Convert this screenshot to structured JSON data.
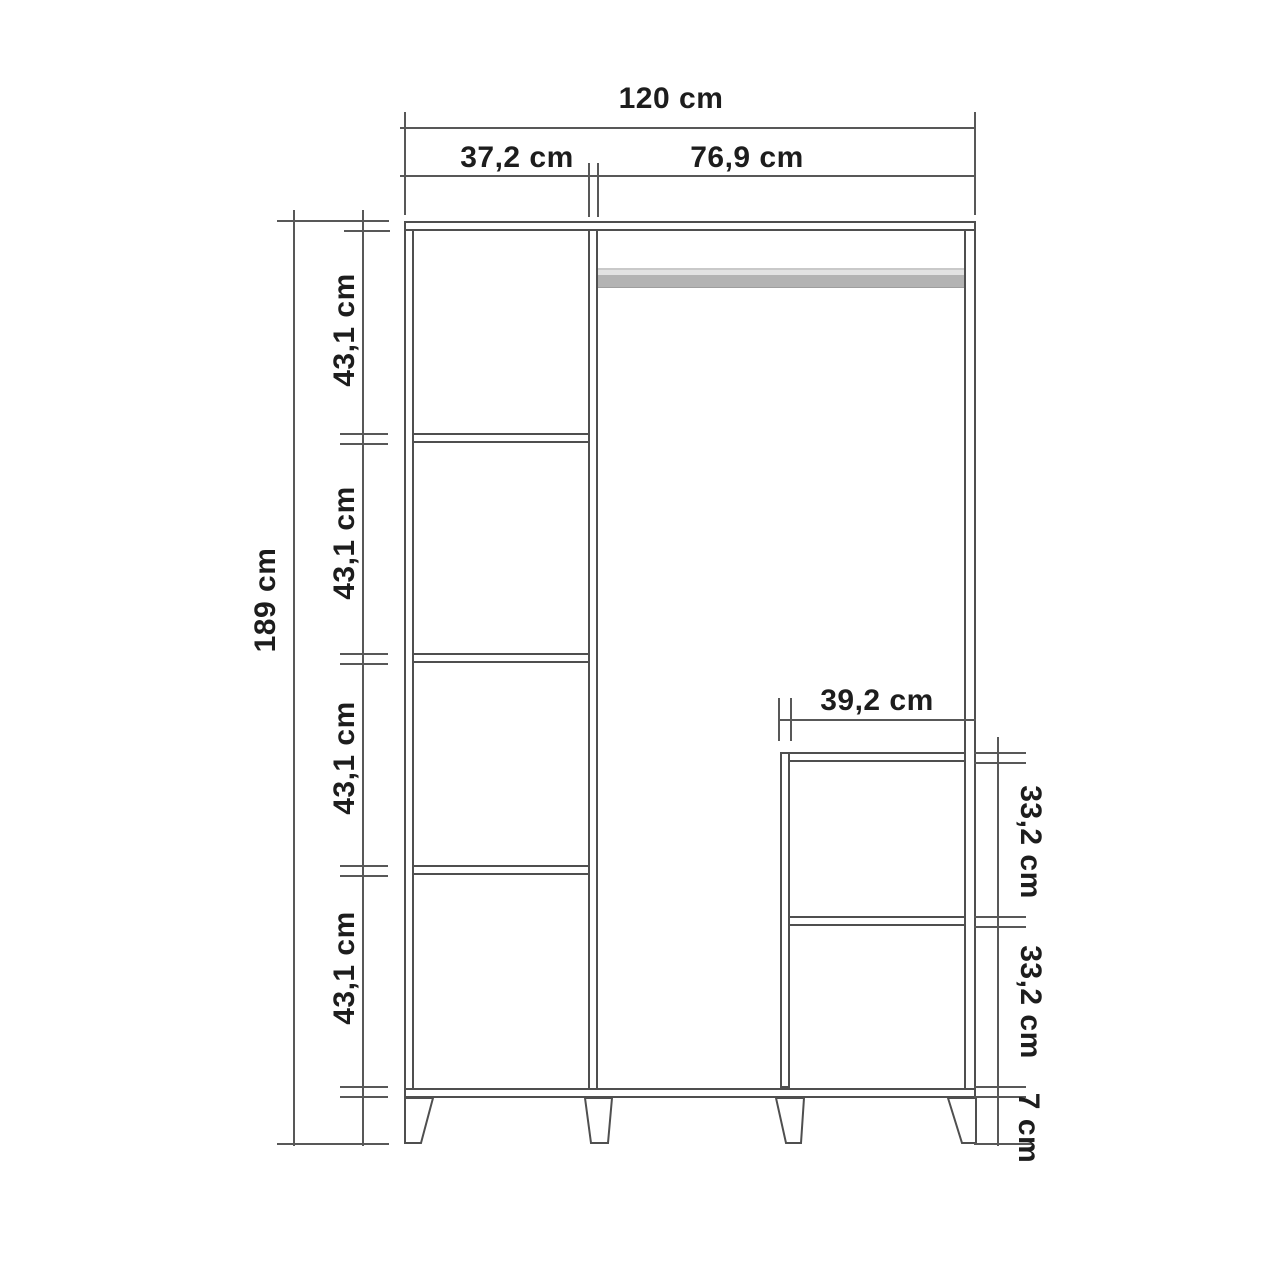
{
  "diagram": {
    "type": "furniture technical drawing",
    "subject": "wardrobe front elevation with dimensions",
    "unit": "cm",
    "overall": {
      "width": "120 cm",
      "height": "189 cm"
    },
    "top_sections": {
      "left": "37,2 cm",
      "right": "76,9 cm"
    },
    "left_column": {
      "gaps": [
        "43,1 cm",
        "43,1 cm",
        "43,1 cm",
        "43,1 cm"
      ]
    },
    "inner_compartment": {
      "width": "39,2 cm",
      "upper_gap": "33,2 cm",
      "lower_gap": "33,2 cm"
    },
    "base": {
      "leg_height": "7 cm"
    },
    "colors": {
      "background": "#ffffff",
      "lines": "#4f4f4f",
      "dimension_lines": "#585858",
      "text": "#1d1d1d",
      "rail": "#b3b3b3"
    }
  }
}
